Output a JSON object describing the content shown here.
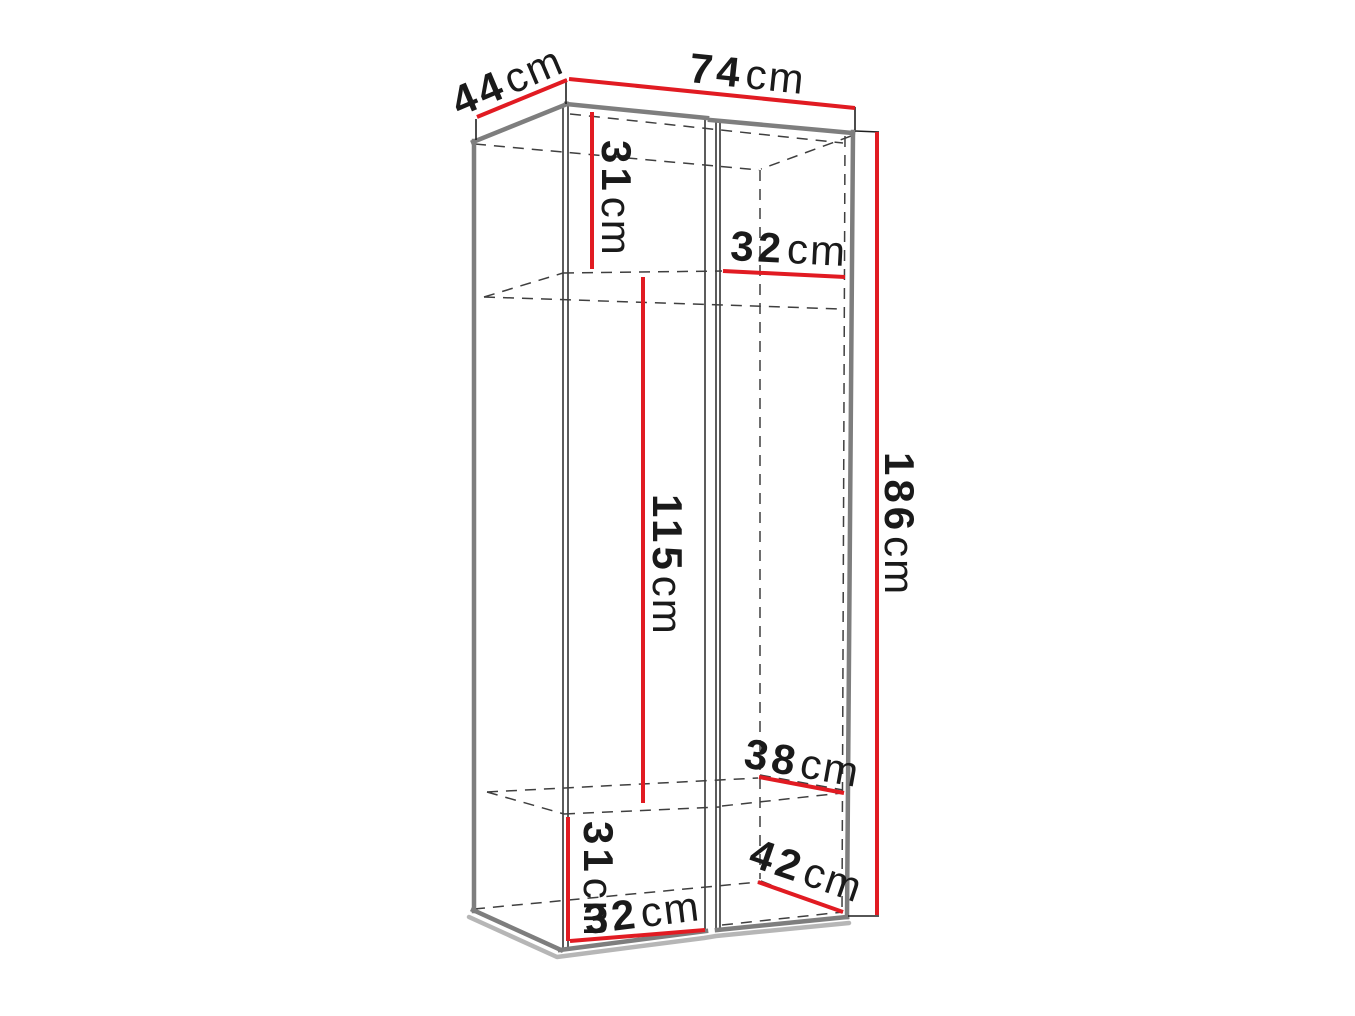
{
  "style": {
    "bg": "#ffffff",
    "red": "#e11b22",
    "edge": "#7e7e7e",
    "shadow": "#b6b6b6",
    "line": "#3f3f3f",
    "tick": "#1f1f1f",
    "text": "#1a1a1a"
  },
  "diagram": {
    "kind": "furniture-dimension-wireframe",
    "subject": "two-door wardrobe line drawing with red dimension lines"
  },
  "dims": {
    "depth_top": {
      "value": "44",
      "unit": "cm"
    },
    "width_top": {
      "value": "74",
      "unit": "cm"
    },
    "upper_left_height": {
      "value": "31",
      "unit": "cm"
    },
    "upper_right_width": {
      "value": "32",
      "unit": "cm"
    },
    "middle_height": {
      "value": "115",
      "unit": "cm"
    },
    "total_height": {
      "value": "186",
      "unit": "cm"
    },
    "lower_right_depth": {
      "value": "38",
      "unit": "cm"
    },
    "lower_left_height": {
      "value": "31",
      "unit": "cm"
    },
    "bottom_right_depth": {
      "value": "42",
      "unit": "cm"
    },
    "bottom_width": {
      "value": "32",
      "unit": "cm"
    }
  }
}
